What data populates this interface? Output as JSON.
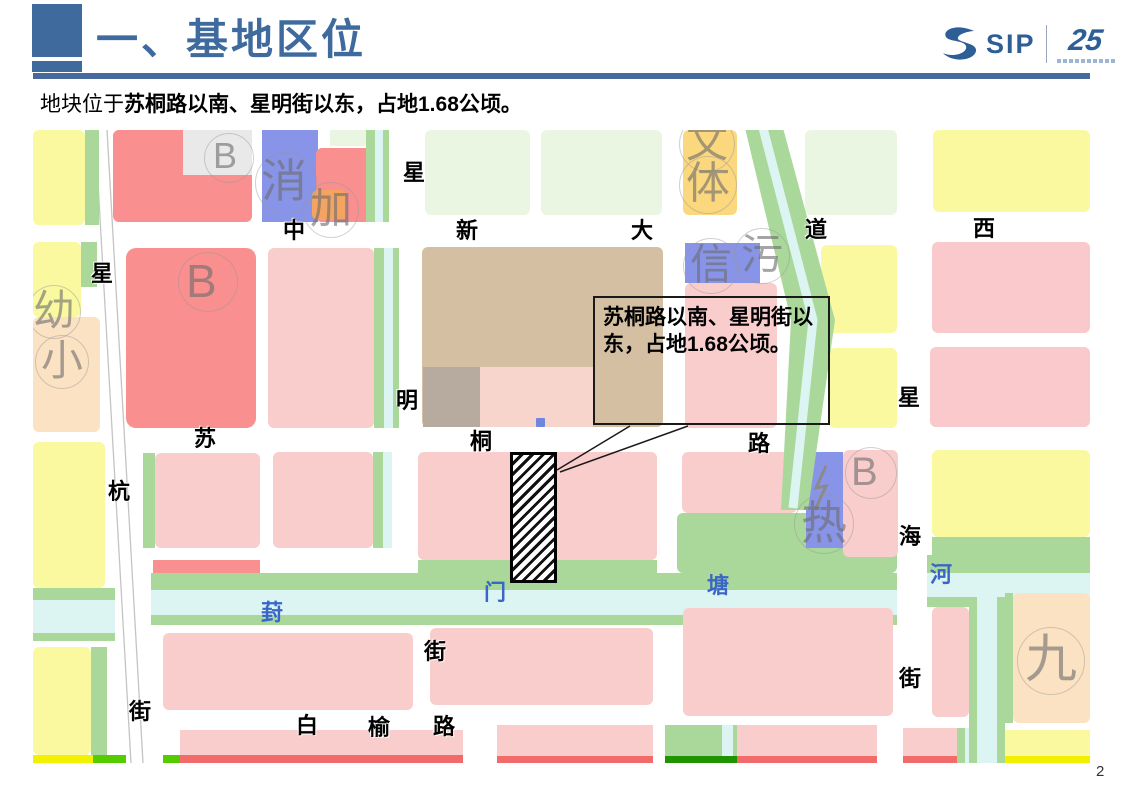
{
  "slide": {
    "title": "一、基地区位",
    "subtitle_prefix": "地块位于",
    "subtitle_emphasis": "苏桐路以南、星明街以东，占地1.68公顷。",
    "page_number": "2",
    "accent_color": "#3E6A9E",
    "rule_color": "#47699B",
    "logo": {
      "brand": "SIP",
      "anniversary": "25"
    }
  },
  "callout": {
    "text": "苏桐路以南、星明街以东，占地1.68公顷。"
  },
  "map": {
    "site": {
      "x": 477,
      "y": 322,
      "w": 47,
      "h": 131
    },
    "leader_lines": [
      [
        597,
        296,
        524,
        340
      ],
      [
        655,
        296,
        527,
        342
      ]
    ],
    "road_lines": [
      [
        62,
        0,
        98,
        633
      ],
      [
        74,
        0,
        110,
        633
      ]
    ],
    "power_zigzag": "793,336 783,358 793,356 782,380",
    "diag_river": {
      "poly": "712,-2 750,-2 802,190 775,380 748,380 758,190",
      "center": "730,-2 780,190 760,378",
      "fill": "#A9D89A",
      "center_color": "#DCF4F2"
    },
    "parcels": [
      {
        "x": 0,
        "y": 0,
        "w": 52,
        "h": 95,
        "c": "#FAF9A0"
      },
      {
        "x": 52,
        "y": 0,
        "w": 14,
        "h": 95,
        "c": "#A9D89A",
        "r": 0
      },
      {
        "x": 0,
        "y": 112,
        "w": 48,
        "h": 75,
        "c": "#FAF9A0"
      },
      {
        "x": 48,
        "y": 112,
        "w": 16,
        "h": 45,
        "c": "#A9D89A",
        "r": 0
      },
      {
        "x": 0,
        "y": 187,
        "w": 67,
        "h": 115,
        "c": "#FBE2C2"
      },
      {
        "x": 0,
        "y": 312,
        "w": 72,
        "h": 146,
        "c": "#FAF9A0"
      },
      {
        "x": 0,
        "y": 458,
        "w": 82,
        "h": 12,
        "c": "#A9D89A",
        "r": 0
      },
      {
        "x": 0,
        "y": 470,
        "w": 82,
        "h": 33,
        "c": "#DCF4F2",
        "r": 0
      },
      {
        "x": 0,
        "y": 503,
        "w": 82,
        "h": 8,
        "c": "#A9D89A",
        "r": 0
      },
      {
        "x": 0,
        "y": 517,
        "w": 58,
        "h": 108,
        "c": "#FAF9A0"
      },
      {
        "x": 58,
        "y": 517,
        "w": 16,
        "h": 108,
        "c": "#A9D89A",
        "r": 0
      },
      {
        "x": 0,
        "y": 625,
        "w": 60,
        "h": 8,
        "c": "#F2F200",
        "r": 0
      },
      {
        "x": 60,
        "y": 625,
        "w": 33,
        "h": 8,
        "c": "#55CC00",
        "r": 0
      },
      {
        "x": 130,
        "y": 625,
        "w": 18,
        "h": 8,
        "c": "#55CC00",
        "r": 0
      },
      {
        "x": 80,
        "y": 0,
        "w": 139,
        "h": 92,
        "c": "#F98F8F"
      },
      {
        "x": 150,
        "y": 0,
        "w": 69,
        "h": 45,
        "c": "#E9E9E9",
        "r": 0
      },
      {
        "x": 93,
        "y": 118,
        "w": 130,
        "h": 180,
        "c": "#F98F8F",
        "r": 10
      },
      {
        "x": 110,
        "y": 323,
        "w": 12,
        "h": 95,
        "c": "#A9D89A",
        "r": 0
      },
      {
        "x": 122,
        "y": 323,
        "w": 105,
        "h": 95,
        "c": "#FACDCD"
      },
      {
        "x": 120,
        "y": 430,
        "w": 107,
        "h": 23,
        "c": "#F98F8F",
        "r": 0
      },
      {
        "x": 130,
        "y": 503,
        "w": 250,
        "h": 77,
        "c": "#FACDCD"
      },
      {
        "x": 147,
        "y": 600,
        "w": 283,
        "h": 25,
        "c": "#FACDCD",
        "r": 0
      },
      {
        "x": 147,
        "y": 625,
        "w": 283,
        "h": 8,
        "c": "#F26B6B",
        "r": 0
      },
      {
        "x": 229,
        "y": 0,
        "w": 56,
        "h": 92,
        "c": "#8894E8",
        "r": 0
      },
      {
        "x": 283,
        "y": 18,
        "w": 62,
        "h": 74,
        "c": "#F98F8F"
      },
      {
        "x": 297,
        "y": 0,
        "w": 36,
        "h": 16,
        "c": "#EAF6E2",
        "r": 0
      },
      {
        "x": 279,
        "y": 60,
        "w": 34,
        "h": 30,
        "c": "#F4A460"
      },
      {
        "x": 333,
        "y": 0,
        "w": 9,
        "h": 92,
        "c": "#A9D89A",
        "r": 0
      },
      {
        "x": 342,
        "y": 0,
        "w": 8,
        "h": 92,
        "c": "#DCF4F2",
        "r": 0
      },
      {
        "x": 350,
        "y": 0,
        "w": 6,
        "h": 92,
        "c": "#A9D89A",
        "r": 0
      },
      {
        "x": 235,
        "y": 118,
        "w": 106,
        "h": 180,
        "c": "#FACDCD"
      },
      {
        "x": 341,
        "y": 118,
        "w": 10,
        "h": 180,
        "c": "#A9D89A",
        "r": 0
      },
      {
        "x": 351,
        "y": 118,
        "w": 9,
        "h": 180,
        "c": "#DCF4F2",
        "r": 0
      },
      {
        "x": 360,
        "y": 118,
        "w": 6,
        "h": 180,
        "c": "#A9D89A",
        "r": 0
      },
      {
        "x": 240,
        "y": 322,
        "w": 100,
        "h": 96,
        "c": "#FACDCD"
      },
      {
        "x": 340,
        "y": 322,
        "w": 10,
        "h": 96,
        "c": "#A9D89A",
        "r": 0
      },
      {
        "x": 350,
        "y": 322,
        "w": 9,
        "h": 96,
        "c": "#DCF4F2",
        "r": 0
      },
      {
        "x": 392,
        "y": 0,
        "w": 105,
        "h": 85,
        "c": "#EAF6E2"
      },
      {
        "x": 508,
        "y": 0,
        "w": 121,
        "h": 85,
        "c": "#EAF6E2"
      },
      {
        "x": 650,
        "y": 0,
        "w": 54,
        "h": 85,
        "c": "#FBD87E"
      },
      {
        "x": 389,
        "y": 117,
        "w": 241,
        "h": 180,
        "c": "#D5BFA3"
      },
      {
        "x": 390,
        "y": 237,
        "w": 57,
        "h": 60,
        "c": "#B6AB9E",
        "r": 0
      },
      {
        "x": 447,
        "y": 237,
        "w": 113,
        "h": 60,
        "c": "#F8D5CC",
        "r": 0
      },
      {
        "x": 503,
        "y": 288,
        "w": 9,
        "h": 9,
        "c": "#6E86E0",
        "r": 1
      },
      {
        "x": 652,
        "y": 113,
        "w": 75,
        "h": 40,
        "c": "#8894E8",
        "r": 0
      },
      {
        "x": 652,
        "y": 153,
        "w": 92,
        "h": 145,
        "c": "#FACDCD"
      },
      {
        "x": 772,
        "y": 0,
        "w": 92,
        "h": 85,
        "c": "#EAF6E2"
      },
      {
        "x": 788,
        "y": 115,
        "w": 76,
        "h": 88,
        "c": "#FAF9A0"
      },
      {
        "x": 796,
        "y": 218,
        "w": 68,
        "h": 80,
        "c": "#FAF9A0"
      },
      {
        "x": 385,
        "y": 322,
        "w": 239,
        "h": 108,
        "c": "#FACDCD"
      },
      {
        "x": 385,
        "y": 430,
        "w": 239,
        "h": 15,
        "c": "#A9D89A",
        "r": 0
      },
      {
        "x": 649,
        "y": 322,
        "w": 115,
        "h": 61,
        "c": "#FACDCD"
      },
      {
        "x": 644,
        "y": 383,
        "w": 220,
        "h": 60,
        "c": "#A9D89A"
      },
      {
        "x": 773,
        "y": 322,
        "w": 37,
        "h": 96,
        "c": "#8894E8",
        "r": 0
      },
      {
        "x": 810,
        "y": 320,
        "w": 55,
        "h": 107,
        "c": "#FACDCD"
      },
      {
        "x": 900,
        "y": 0,
        "w": 157,
        "h": 82,
        "c": "#FAF9A0"
      },
      {
        "x": 899,
        "y": 112,
        "w": 158,
        "h": 91,
        "c": "#F9C9CB"
      },
      {
        "x": 897,
        "y": 217,
        "w": 160,
        "h": 80,
        "c": "#F9C9CB"
      },
      {
        "x": 899,
        "y": 320,
        "w": 158,
        "h": 87,
        "c": "#FAF9A0"
      },
      {
        "x": 899,
        "y": 407,
        "w": 158,
        "h": 18,
        "c": "#A9D89A",
        "r": 0
      },
      {
        "x": 894,
        "y": 425,
        "w": 163,
        "h": 18,
        "c": "#A9D89A",
        "r": 0
      },
      {
        "x": 894,
        "y": 443,
        "w": 163,
        "h": 24,
        "c": "#DCF4F2",
        "r": 0
      },
      {
        "x": 894,
        "y": 467,
        "w": 163,
        "h": 10,
        "c": "#A9D89A",
        "r": 0
      },
      {
        "x": 118,
        "y": 443,
        "w": 746,
        "h": 17,
        "c": "#A9D89A",
        "r": 0
      },
      {
        "x": 118,
        "y": 460,
        "w": 746,
        "h": 25,
        "c": "#DCF4F2",
        "r": 0
      },
      {
        "x": 118,
        "y": 485,
        "w": 746,
        "h": 10,
        "c": "#A9D89A",
        "r": 0
      },
      {
        "x": 397,
        "y": 498,
        "w": 223,
        "h": 77,
        "c": "#FACDCD"
      },
      {
        "x": 650,
        "y": 478,
        "w": 210,
        "h": 108,
        "c": "#FACDCD"
      },
      {
        "x": 464,
        "y": 595,
        "w": 156,
        "h": 35,
        "c": "#FACDCD",
        "r": 0
      },
      {
        "x": 464,
        "y": 626,
        "w": 156,
        "h": 7,
        "c": "#F26B6B",
        "r": 0
      },
      {
        "x": 632,
        "y": 595,
        "w": 105,
        "h": 31,
        "c": "#A9D89A",
        "r": 0
      },
      {
        "x": 689,
        "y": 595,
        "w": 11,
        "h": 31,
        "c": "#DCF4F2",
        "r": 0
      },
      {
        "x": 632,
        "y": 626,
        "w": 105,
        "h": 7,
        "c": "#1F9400",
        "r": 0
      },
      {
        "x": 704,
        "y": 595,
        "w": 140,
        "h": 31,
        "c": "#FACDCD",
        "r": 0
      },
      {
        "x": 704,
        "y": 626,
        "w": 140,
        "h": 7,
        "c": "#F26B6B",
        "r": 0
      },
      {
        "x": 870,
        "y": 598,
        "w": 54,
        "h": 28,
        "c": "#FACDCD",
        "r": 0
      },
      {
        "x": 870,
        "y": 626,
        "w": 54,
        "h": 7,
        "c": "#F26B6B",
        "r": 0
      },
      {
        "x": 924,
        "y": 598,
        "w": 8,
        "h": 35,
        "c": "#A9D89A",
        "r": 0
      },
      {
        "x": 932,
        "y": 598,
        "w": 12,
        "h": 35,
        "c": "#DCF4F2",
        "r": 0
      },
      {
        "x": 942,
        "y": 598,
        "w": 8,
        "h": 35,
        "c": "#A9D89A",
        "r": 0
      },
      {
        "x": 950,
        "y": 600,
        "w": 107,
        "h": 26,
        "c": "#FAF9A0",
        "r": 0
      },
      {
        "x": 950,
        "y": 626,
        "w": 107,
        "h": 7,
        "c": "#F0F000",
        "r": 0
      },
      {
        "x": 899,
        "y": 477,
        "w": 37,
        "h": 110,
        "c": "#FACDCD"
      },
      {
        "x": 936,
        "y": 467,
        "w": 8,
        "h": 166,
        "c": "#A9D89A",
        "r": 0
      },
      {
        "x": 944,
        "y": 467,
        "w": 20,
        "h": 166,
        "c": "#DCF4F2",
        "r": 0
      },
      {
        "x": 964,
        "y": 467,
        "w": 8,
        "h": 166,
        "c": "#A9D89A",
        "r": 0
      },
      {
        "x": 972,
        "y": 463,
        "w": 8,
        "h": 130,
        "c": "#A9D89A",
        "r": 0
      },
      {
        "x": 980,
        "y": 463,
        "w": 77,
        "h": 130,
        "c": "#FBE2C2"
      }
    ],
    "street_labels": [
      {
        "t": "星",
        "x": 58,
        "y": 133
      },
      {
        "t": "杭",
        "x": 75,
        "y": 351
      },
      {
        "t": "街",
        "x": 96,
        "y": 571
      },
      {
        "t": "中",
        "x": 250,
        "y": 90
      },
      {
        "t": "新",
        "x": 423,
        "y": 90
      },
      {
        "t": "大",
        "x": 598,
        "y": 90
      },
      {
        "t": "道",
        "x": 772,
        "y": 89
      },
      {
        "t": "西",
        "x": 940,
        "y": 88
      },
      {
        "t": "星",
        "x": 370,
        "y": 32
      },
      {
        "t": "明",
        "x": 363,
        "y": 260
      },
      {
        "t": "街",
        "x": 391,
        "y": 511
      },
      {
        "t": "苏",
        "x": 161,
        "y": 298
      },
      {
        "t": "桐",
        "x": 437,
        "y": 301
      },
      {
        "t": "路",
        "x": 715,
        "y": 303
      },
      {
        "t": "星",
        "x": 865,
        "y": 257
      },
      {
        "t": "海",
        "x": 866,
        "y": 396
      },
      {
        "t": "街",
        "x": 866,
        "y": 538
      },
      {
        "t": "白",
        "x": 263,
        "y": 585
      },
      {
        "t": "榆",
        "x": 335,
        "y": 587
      },
      {
        "t": "路",
        "x": 400,
        "y": 586
      }
    ],
    "river_labels": [
      {
        "t": "葑",
        "x": 228,
        "y": 472
      },
      {
        "t": "门",
        "x": 451,
        "y": 452
      },
      {
        "t": "塘",
        "x": 674,
        "y": 445
      },
      {
        "t": "河",
        "x": 897,
        "y": 434
      }
    ],
    "watermarks": [
      {
        "t": "B",
        "x": 180,
        "y": 8,
        "s": 36,
        "cx": 196,
        "cy": 28,
        "r": 25
      },
      {
        "t": "B",
        "x": 153,
        "y": 128,
        "s": 46,
        "cx": 175,
        "cy": 152,
        "r": 30
      },
      {
        "t": "消",
        "x": 228,
        "y": 28,
        "s": 46,
        "cx": 253,
        "cy": 53,
        "r": 31
      },
      {
        "t": "加",
        "x": 277,
        "y": 58,
        "s": 42,
        "cx": 298,
        "cy": 80,
        "r": 28
      },
      {
        "t": "幼",
        "x": 0,
        "y": 160,
        "s": 42,
        "cx": 21,
        "cy": 182,
        "r": 27
      },
      {
        "t": "小",
        "x": 8,
        "y": 210,
        "s": 42,
        "cx": 29,
        "cy": 232,
        "r": 27
      },
      {
        "t": "文",
        "x": 653,
        "y": -8,
        "s": 42,
        "cx": 674,
        "cy": 14,
        "r": 28
      },
      {
        "t": "体",
        "x": 653,
        "y": 32,
        "s": 44,
        "cx": 675,
        "cy": 55,
        "r": 29
      },
      {
        "t": "信",
        "x": 657,
        "y": 114,
        "s": 42,
        "cx": 678,
        "cy": 136,
        "r": 28
      },
      {
        "t": "污",
        "x": 708,
        "y": 104,
        "s": 42,
        "cx": 729,
        "cy": 126,
        "r": 28
      },
      {
        "t": "热",
        "x": 768,
        "y": 370,
        "s": 46,
        "cx": 791,
        "cy": 394,
        "r": 30
      },
      {
        "t": "B",
        "x": 818,
        "y": 322,
        "s": 40,
        "cx": 838,
        "cy": 343,
        "r": 26
      },
      {
        "t": "九",
        "x": 992,
        "y": 504,
        "s": 52,
        "cx": 1018,
        "cy": 531,
        "r": 34
      }
    ]
  }
}
